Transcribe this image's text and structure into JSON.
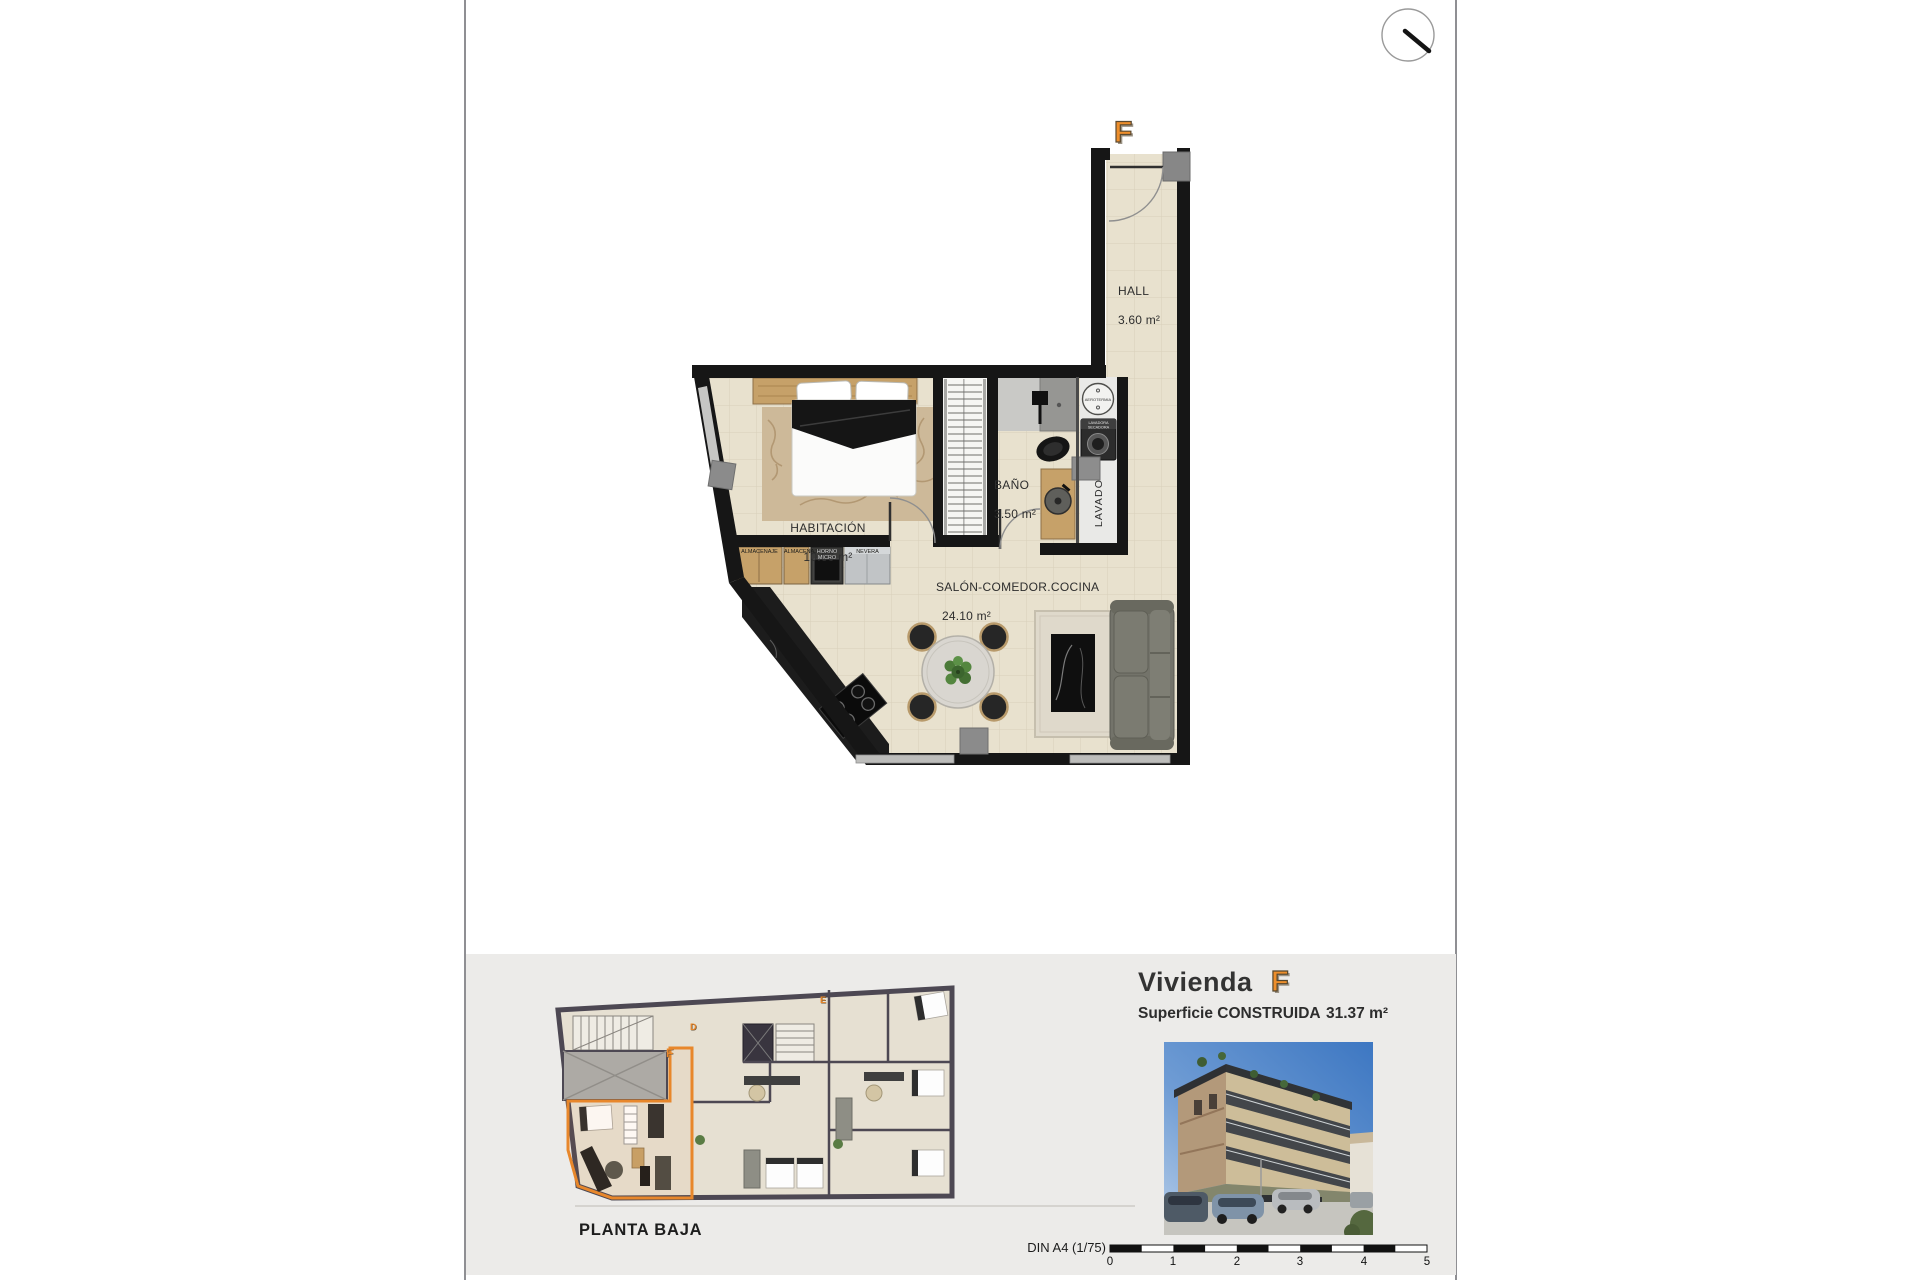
{
  "floor_plan": {
    "unit_letter": "F",
    "rooms": {
      "hall": {
        "name": "HALL",
        "area": "3.60 m²"
      },
      "bathroom": {
        "name": "BAÑO",
        "area": "3.50 m²"
      },
      "bedroom": {
        "name": "HABITACIÓN",
        "area": "10.60 m²"
      },
      "living": {
        "name": "SALÓN-COMEDOR.COCINA",
        "area": "24.10 m²"
      },
      "laundry": {
        "name": "LAVADO"
      }
    },
    "fixtures": {
      "aerotermia": "AEROTERMIA",
      "washer_line1": "LAVADORA",
      "washer_line2": "SECADORA"
    },
    "kitchen_labels": [
      "ALMACENAJE",
      "ALMACENAJE",
      "HORNO MICRO",
      "NEVERA"
    ]
  },
  "overview": {
    "title": "PLANTA BAJA",
    "unit_letters": {
      "f": "F",
      "d": "D",
      "e": "E"
    }
  },
  "info_panel": {
    "title_prefix": "Vivienda",
    "unit_letter": "F",
    "area_label": "Superficie CONSTRUIDA",
    "area_value": "31.37 m²"
  },
  "scale_bar": {
    "label": "DIN A4 (1/75)",
    "ticks": [
      "0",
      "1",
      "2",
      "3",
      "4",
      "5"
    ]
  },
  "colors": {
    "accent_orange": "#E8872B",
    "wall_black": "#161616",
    "floor_beige": "#E8E1CE",
    "band_gray": "#ECEBE9",
    "wood": "#C6A169"
  }
}
